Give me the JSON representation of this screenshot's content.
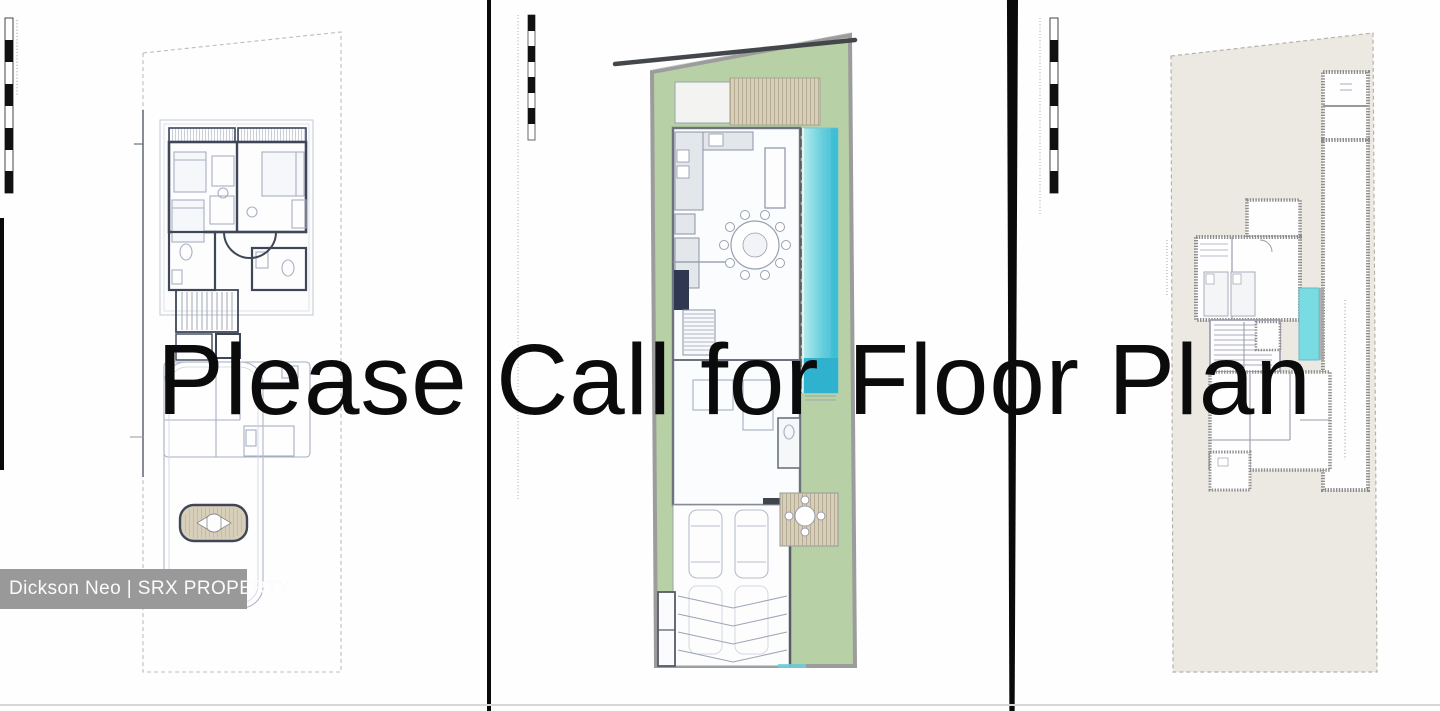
{
  "overlay": {
    "title": "Please Call for Floor Plan"
  },
  "watermark": {
    "text": "Dickson Neo | SRX PROPERTY"
  },
  "panels": {
    "left": {
      "icon": "floor-plan-drawing"
    },
    "middle": {
      "icon": "site-plan-drawing"
    },
    "right": {
      "icon": "site-plan-drawing"
    }
  },
  "colors": {
    "ink": "#0b0b0b",
    "divider": "#0a0a0a",
    "watermark_bg": "#999999",
    "watermark_text": "#fbfbfb",
    "lawn": "#b7d0a5",
    "deck": "#d8cfba",
    "site": "#ece9e2",
    "pool_deep": "#2fb2cd",
    "pool_small": "#79dce2",
    "wall_dark": "#3e4657",
    "sketch": "#a7afc2",
    "counter": "#e3e7ec",
    "baseline": "#d6d6d6"
  }
}
